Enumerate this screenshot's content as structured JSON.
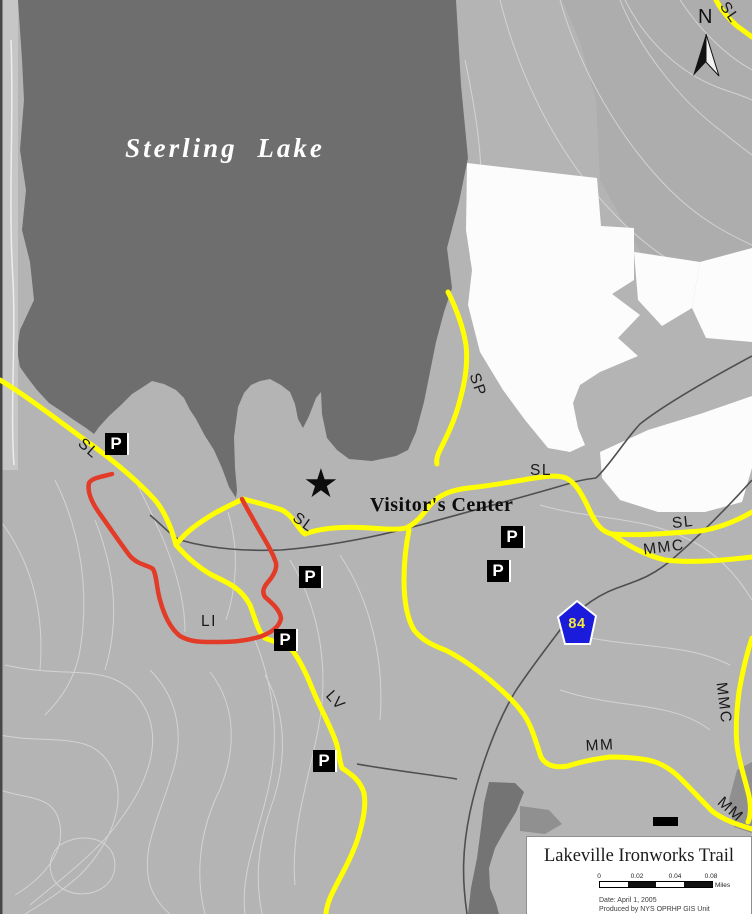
{
  "map": {
    "lake_label": "Sterling Lake",
    "visitor_center_label": "Visitor's Center",
    "north_label": "N",
    "route_shield_number": "84",
    "parking_symbol": "P",
    "trail_labels": [
      {
        "text": "SL"
      },
      {
        "text": "SL"
      },
      {
        "text": "SL"
      },
      {
        "text": "SL"
      },
      {
        "text": "SL"
      },
      {
        "text": "SP"
      },
      {
        "text": "LI"
      },
      {
        "text": "LV"
      },
      {
        "text": "MMC"
      },
      {
        "text": "MMC"
      },
      {
        "text": "MM"
      },
      {
        "text": "MM"
      }
    ],
    "colors": {
      "terrain_gray": "#b4b4b4",
      "lake_gray": "#6e6e6e",
      "trail_yellow": "#ffff00",
      "trail_red": "#e23b28",
      "road_gray": "#4f4f4f",
      "shield_blue": "#1b1bdb"
    }
  },
  "legend": {
    "title": "Lakeville Ironworks Trail",
    "scale_ticks": [
      "0",
      "0.02",
      "0.04",
      "0.08"
    ],
    "scale_unit": "Miles",
    "date_line": "Date: April 1, 2005",
    "credit_line": "Produced by NYS OPRHP GIS Unit"
  }
}
